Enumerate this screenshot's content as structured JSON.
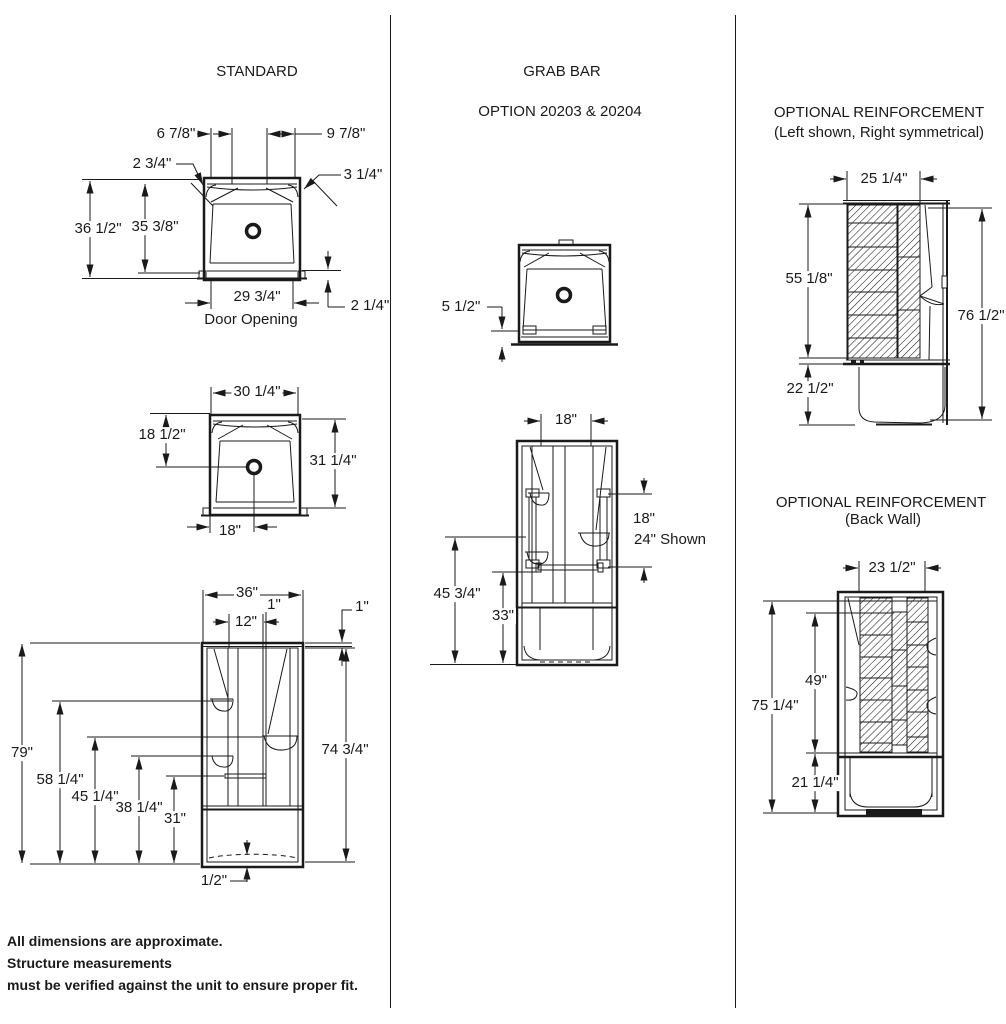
{
  "columns": {
    "standard": {
      "title": "STANDARD",
      "plan_top": {
        "top_left": "6 7/8\"",
        "top_right": "9 7/8\"",
        "corner_left": "2 3/4\"",
        "corner_right": "3 1/4\"",
        "outer_height": "36 1/2\"",
        "inner_height": "35 3/8\"",
        "door_width": "29 3/4\"",
        "door_label": "Door Opening",
        "threshold": "2 1/4\""
      },
      "plan_drain": {
        "width": "30 1/4\"",
        "drain_from_back": "18 1/2\"",
        "height": "31 1/4\"",
        "drain_from_left": "18\""
      },
      "front": {
        "width": "36\"",
        "offset_small": "1\"",
        "recess_width": "12\"",
        "flange": "1\"",
        "total_height": "79\"",
        "shelf_upper": "58 1/4\"",
        "shelf_right": "45 1/4\"",
        "shelf_lower": "38 1/4\"",
        "bar_height": "31\"",
        "inner_height": "74 3/4\"",
        "base_lip": "1/2\""
      }
    },
    "grab_bar": {
      "title": "GRAB BAR",
      "subtitle": "OPTION 20203 & 20204",
      "plan": {
        "front_depth": "5 1/2\""
      },
      "front": {
        "center_width": "18\"",
        "bar_length": "18\"",
        "bar_shown": "24\" Shown",
        "left_height": "45 3/4\"",
        "bar_height": "33\""
      }
    },
    "reinforcement_side": {
      "title": "OPTIONAL REINFORCEMENT",
      "subtitle": "(Left shown, Right symmetrical)",
      "width": "25 1/4\"",
      "upper_height": "55 1/8\"",
      "lower_height": "22 1/2\"",
      "total_height": "76 1/2\""
    },
    "reinforcement_back": {
      "title": "OPTIONAL REINFORCEMENT",
      "subtitle": "(Back Wall)",
      "width": "23 1/2\"",
      "panel_height": "49\"",
      "total_height": "75 1/4\"",
      "lower_height": "21 1/4\""
    }
  },
  "footer": {
    "line1": "All dimensions are approximate.",
    "line2": "Structure measurements",
    "line3": "must be verified against the unit to ensure proper fit."
  }
}
